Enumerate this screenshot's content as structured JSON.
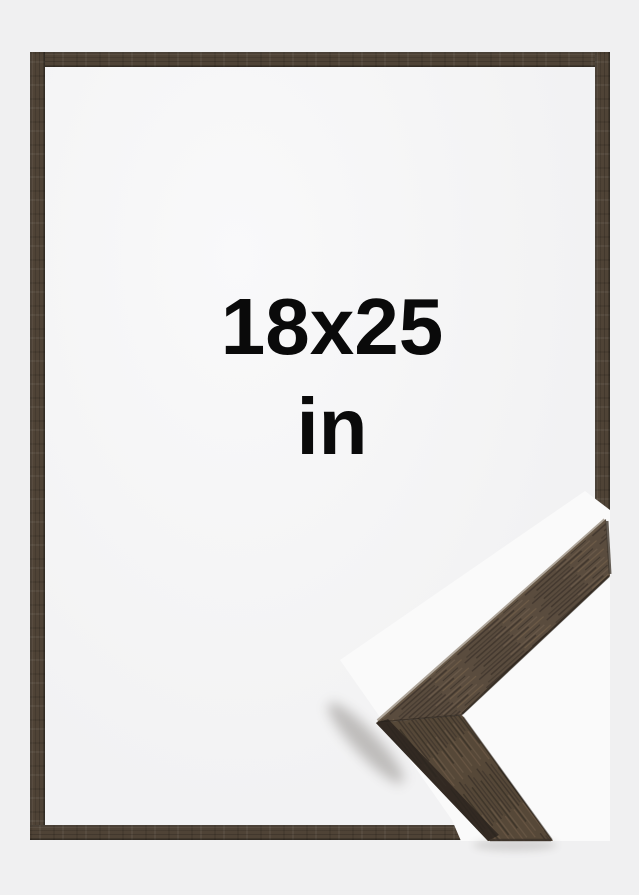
{
  "product_image": {
    "size_label": {
      "line1": "18x25",
      "line2": "in"
    },
    "colors": {
      "page_background": "#f0f0f1",
      "frame_interior": "#f4f4f5",
      "frame_wood_brown": "#4f4336",
      "detail_wood_brown": "#5a4c3e",
      "detail_photo_white": "#fafafa",
      "label_text": "#0a0a0a"
    }
  }
}
